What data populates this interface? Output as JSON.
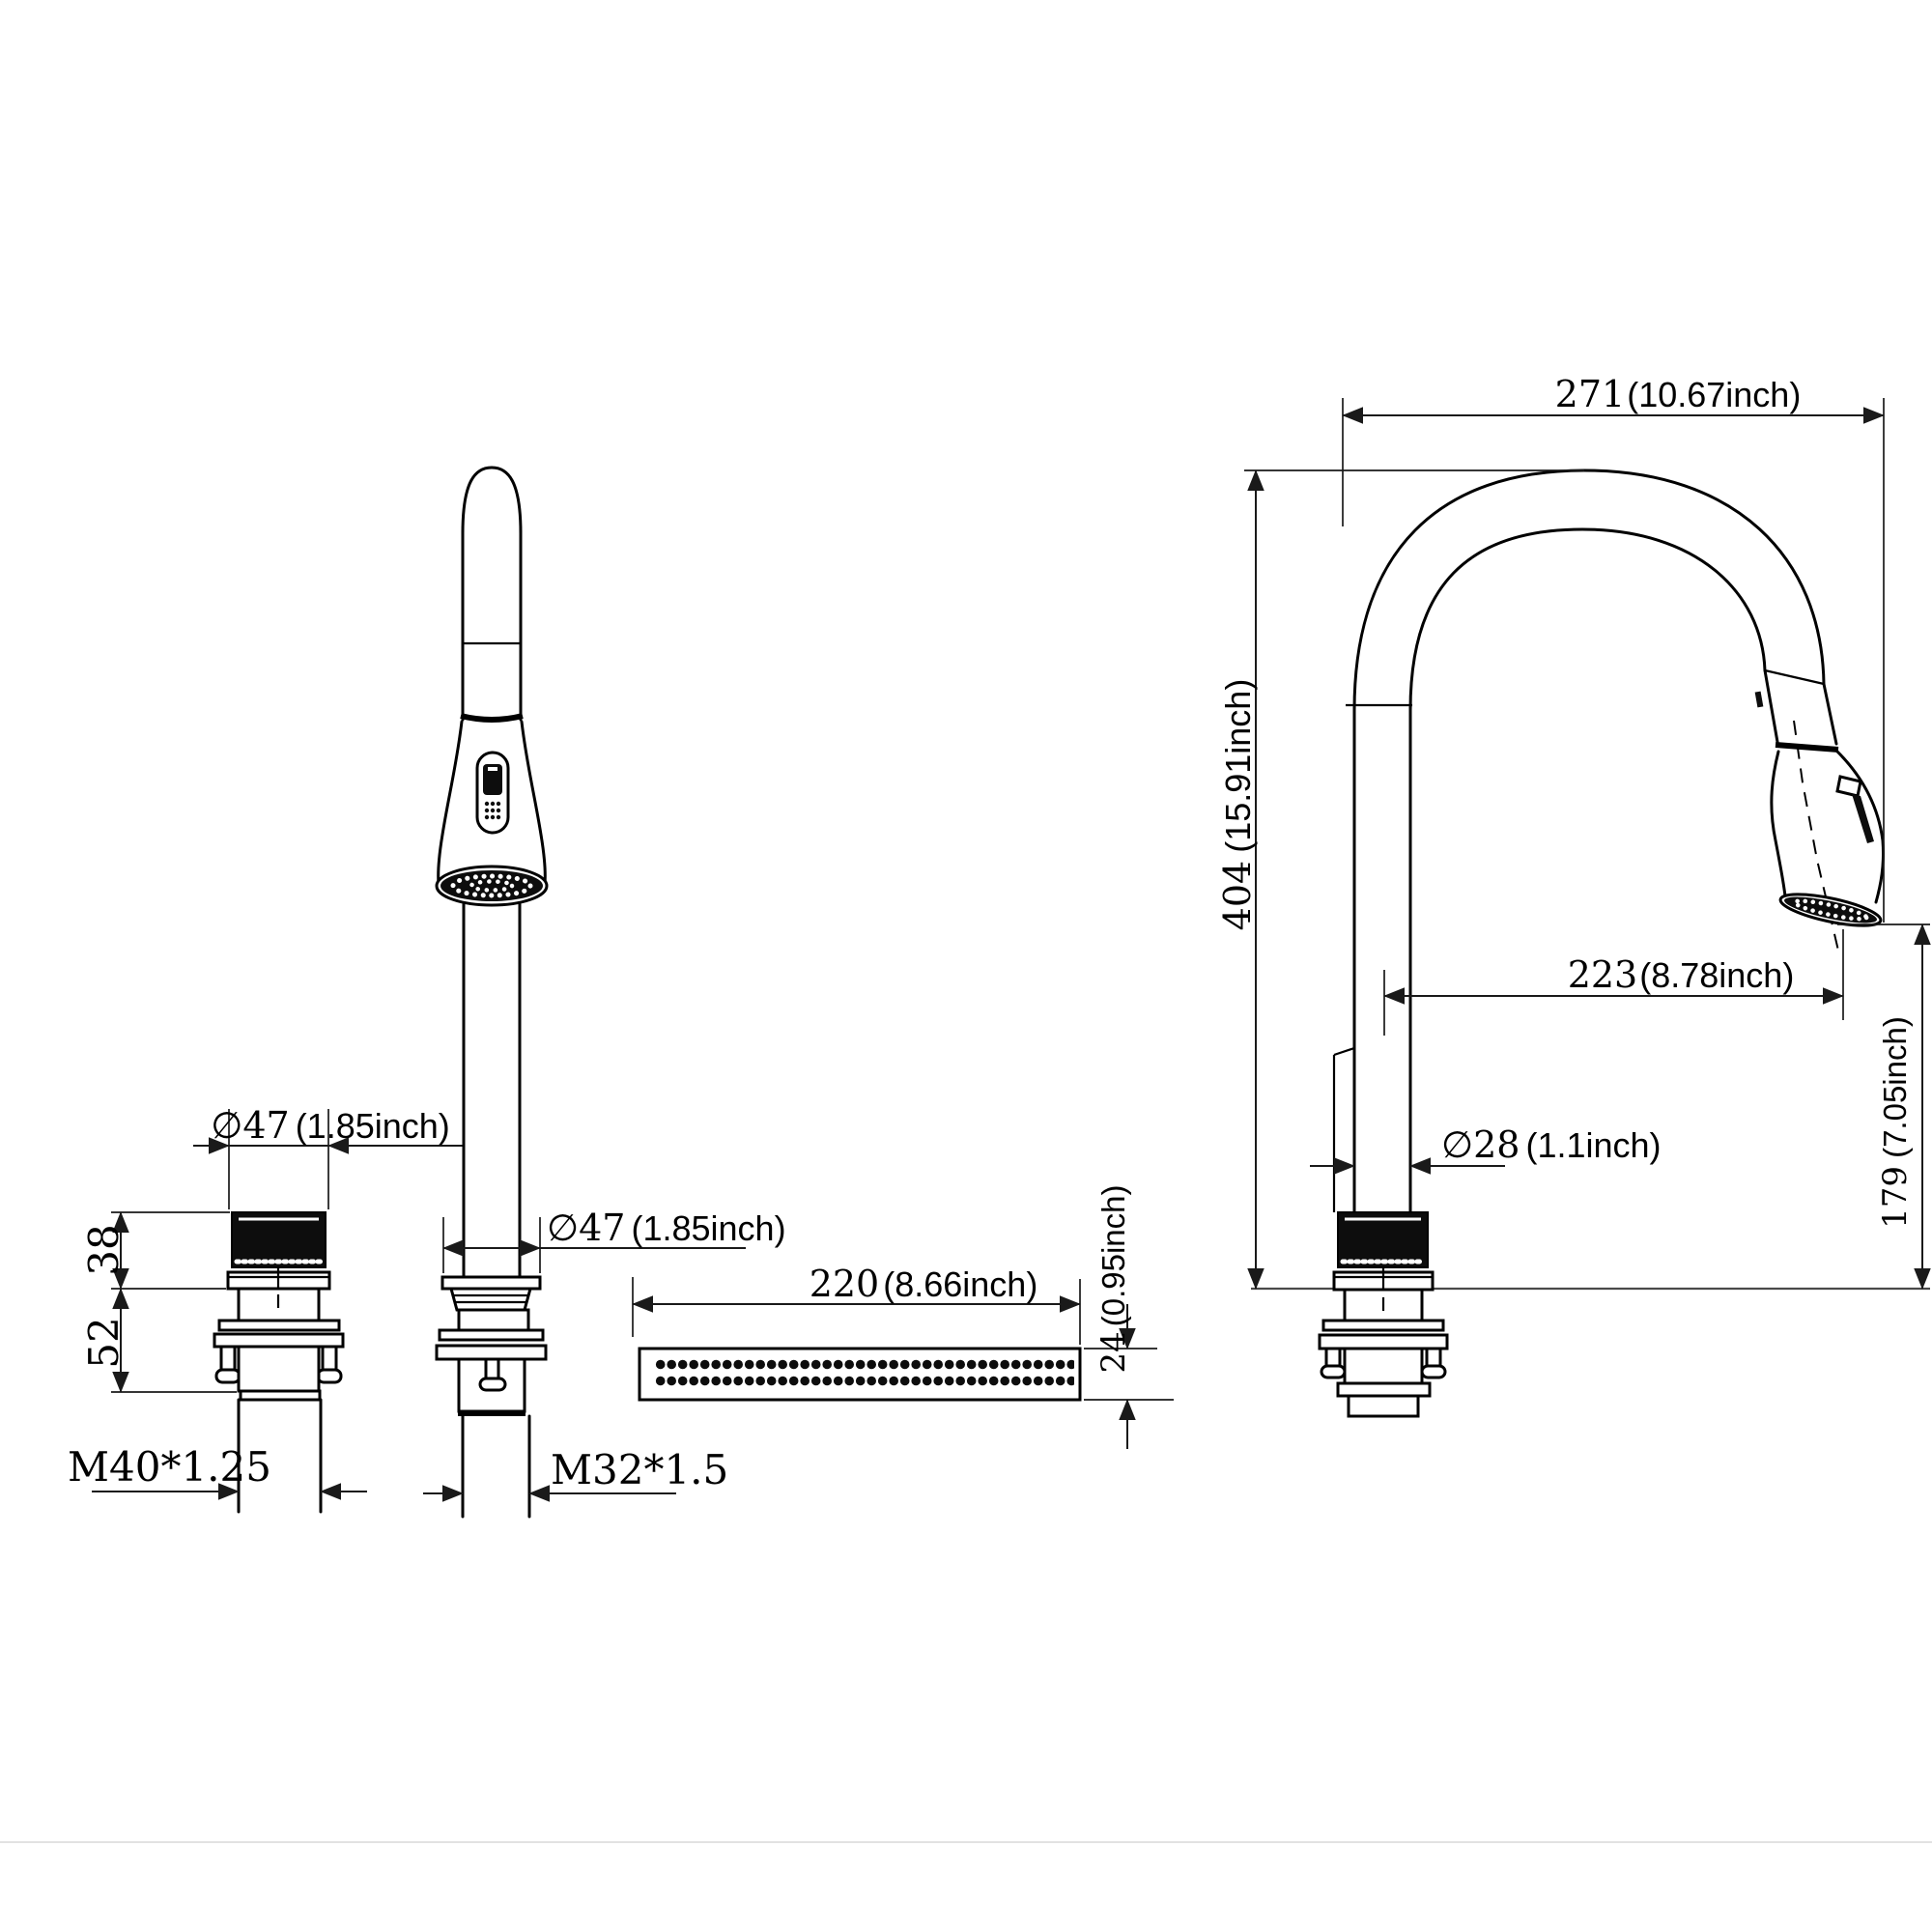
{
  "drawing": {
    "type": "faucet-dimension-drawing",
    "figures": {
      "left_fitting": {
        "cap_diameter": {
          "mm": "∅47",
          "inch": "(1.85inch)"
        },
        "cap_height": {
          "mm": "38"
        },
        "body_height": {
          "mm": "52"
        },
        "thread": {
          "label": "M40*1.25"
        }
      },
      "front_view": {
        "base_diameter": {
          "mm": "∅47",
          "inch": "(1.85inch)"
        },
        "thread": {
          "label": "M32*1.5"
        }
      },
      "spray_bar": {
        "length": {
          "mm": "220",
          "inch": "(8.66inch)"
        },
        "height": {
          "mm": "24",
          "inch": "(0.95inch)"
        }
      },
      "side_view": {
        "overall_width": {
          "mm": "271",
          "inch": "(10.67inch)"
        },
        "overall_height": {
          "mm": "404",
          "inch": "(15.91inch)"
        },
        "spout_reach": {
          "mm": "223",
          "inch": "(8.78inch)"
        },
        "spout_clearance": {
          "mm": "179",
          "inch": "(7.05inch)"
        },
        "tube_diameter": {
          "mm": "∅28",
          "inch": "(1.1inch)"
        }
      }
    }
  }
}
